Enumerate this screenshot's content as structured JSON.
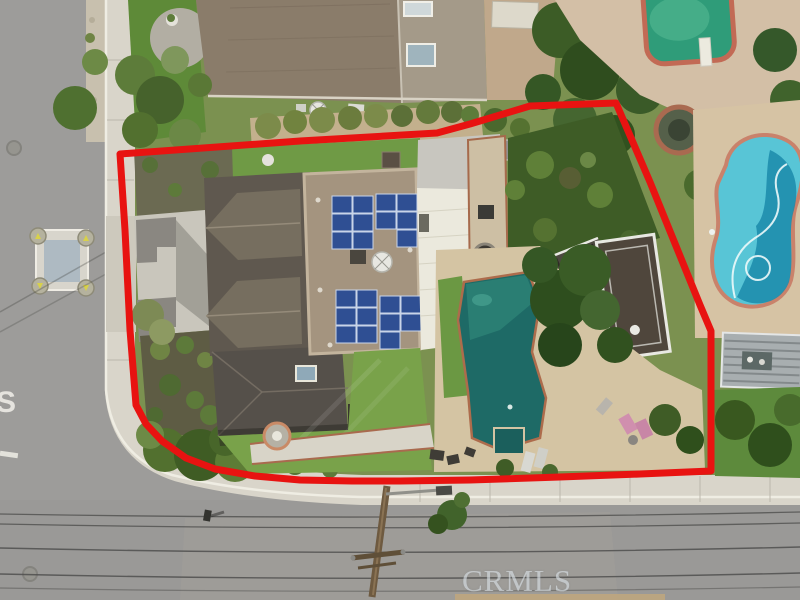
{
  "watermark": {
    "text": "CRMLS"
  },
  "scene": {
    "description": "Aerial drone photo of a corner-lot residential property outlined with a red boundary line; house with rooftop solar panels, backyard pool with deck, neighboring pools, and two intersecting streets",
    "colors": {
      "boundary_red": "#e81311",
      "asphalt": "#9d9c9a",
      "sidewalk": "#d9d5ca",
      "lawn": "#6f9a45",
      "lawn_dark": "#3e5c26",
      "roof_dark": "#5f584f",
      "gable_roof": "#766e5f",
      "flat_roof_tan": "#a4947f",
      "solar_blue": "#2f4f93",
      "patio_cover_white": "#ebe9dd",
      "pool_teal": "#1e6a66",
      "pool_cyan": "#58c5d6",
      "pool_cyan_deep": "#1b89aa",
      "pool_green": "#2f9c79",
      "pool_deck_tan": "#d4c4a3",
      "brick_edge": "#ad6c4c",
      "neighbor_roof_brown": "#8a7c6a"
    },
    "features": [
      "red-property-boundary",
      "main-house-roof",
      "solar-panel-arrays",
      "white-patio-cover",
      "backyard-pool",
      "wood-deck-with-white-railing",
      "neighbor-green-pool",
      "neighbor-kidney-pool",
      "pergola",
      "utility-pole-with-power-lines",
      "crosswalk-utility-vault",
      "driveway",
      "front-walkway-with-fountain"
    ]
  }
}
